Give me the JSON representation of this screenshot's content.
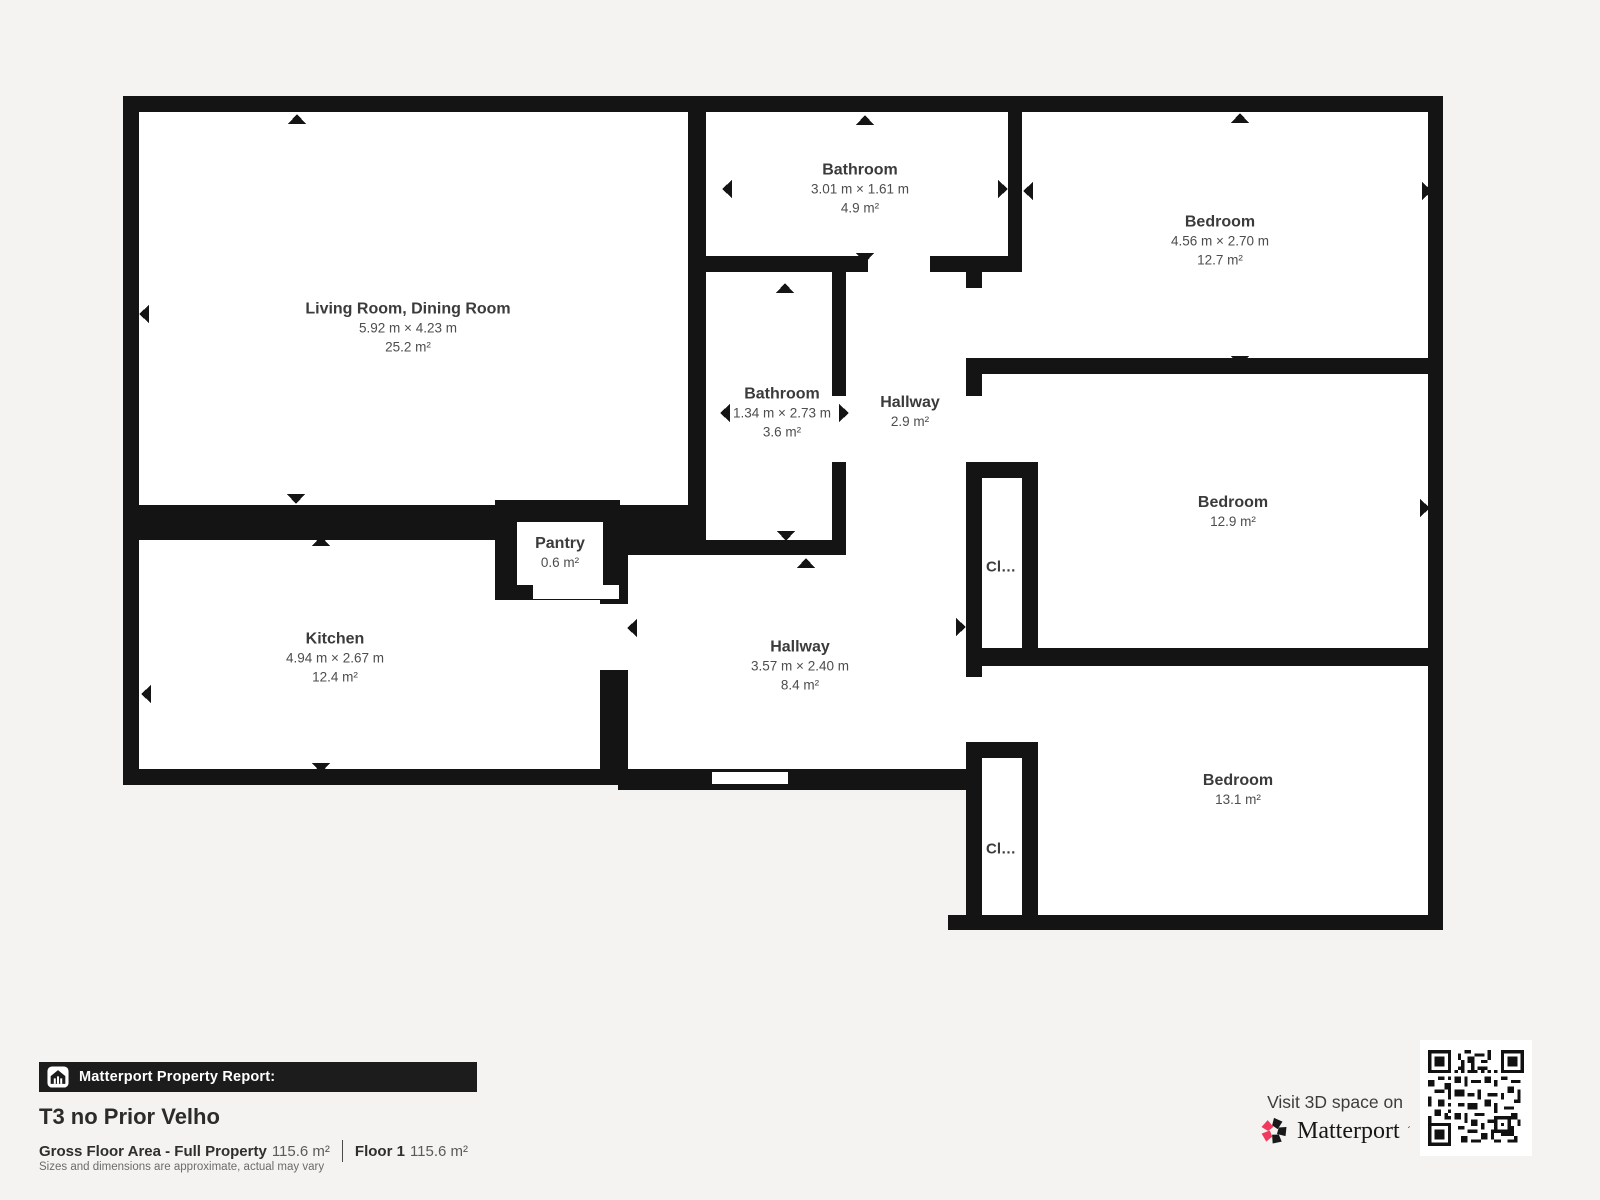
{
  "colors": {
    "background": "#f4f3f1",
    "wall": "#141414",
    "room": "#ffffff",
    "label": "#3b3b3b",
    "banner_bg": "#1c1c1c",
    "brand_pink": "#ef3a5d"
  },
  "rooms": {
    "living": {
      "name": "Living Room, Dining Room",
      "dims": "5.92 m × 4.23 m",
      "area": "25.2 m²"
    },
    "bathroom_top": {
      "name": "Bathroom",
      "dims": "3.01 m × 1.61 m",
      "area": "4.9 m²"
    },
    "bedroom_top": {
      "name": "Bedroom",
      "dims": "4.56 m × 2.70 m",
      "area": "12.7 m²"
    },
    "bathroom_mid": {
      "name": "Bathroom",
      "dims": "1.34 m × 2.73 m",
      "area": "3.6 m²"
    },
    "hallway_upper": {
      "name": "Hallway",
      "area": "2.9 m²"
    },
    "bedroom_mid": {
      "name": "Bedroom",
      "area": "12.9 m²"
    },
    "kitchen": {
      "name": "Kitchen",
      "dims": "4.94 m × 2.67 m",
      "area": "12.4 m²"
    },
    "pantry": {
      "name": "Pantry",
      "area": "0.6 m²"
    },
    "hallway_lower": {
      "name": "Hallway",
      "dims": "3.57 m × 2.40 m",
      "area": "8.4 m²"
    },
    "bedroom_bottom": {
      "name": "Bedroom",
      "area": "13.1 m²"
    },
    "closet_upper": {
      "name": "Cl…"
    },
    "closet_lower": {
      "name": "Cl…"
    }
  },
  "footer": {
    "banner_label": "Matterport Property Report:",
    "property_title": "T3 no Prior Velho",
    "gross_floor_area_label": "Gross Floor Area - Full Property",
    "gross_floor_area_value": "115.6 m²",
    "floor_label": "Floor 1",
    "floor_value": "115.6 m²",
    "disclaimer": "Sizes and dimensions are approximate, actual may vary"
  },
  "cta": {
    "visit_text": "Visit 3D space on",
    "brand_name": "Matterport"
  }
}
